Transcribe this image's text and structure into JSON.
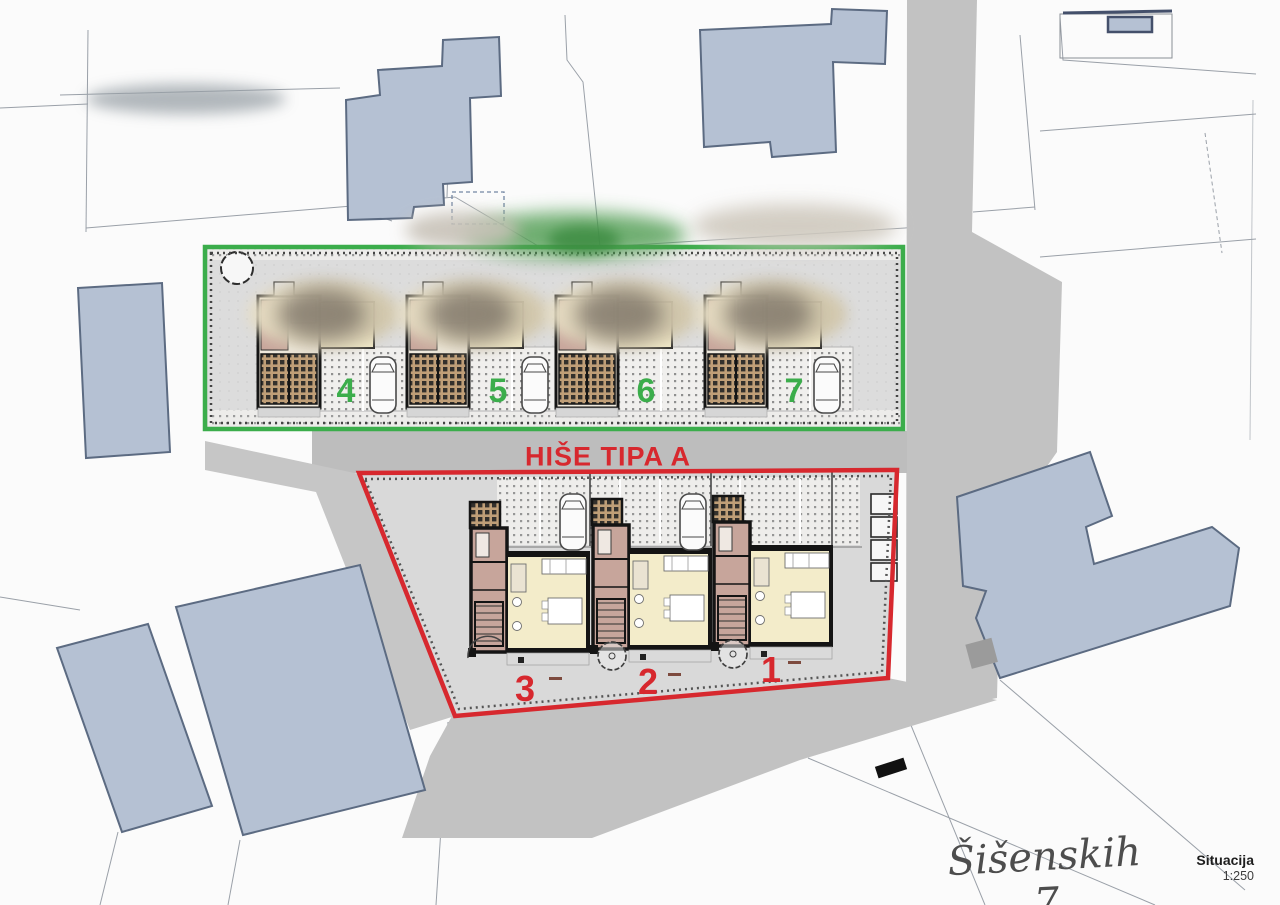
{
  "plan": {
    "zone_green": {
      "house_numbers": [
        "4",
        "5",
        "6",
        "7"
      ],
      "border_color": "#3bad4b"
    },
    "zone_red": {
      "label": "HIŠE TIPA A",
      "house_numbers": [
        "3",
        "2",
        "1"
      ],
      "border_color": "#d7282e"
    }
  },
  "titleblock": {
    "signature": "Šišenskih 7",
    "drawing_title": "Situacija",
    "scale": "1:250"
  },
  "colors": {
    "background": "#fbfbfb",
    "road": "#c2c2c2",
    "zone_ground": "#dcdcdc",
    "existing_building_fill": "#b5c1d3",
    "existing_building_stroke": "#5c6b82",
    "floor_cream": "#f3ecca",
    "hall_pink": "#c7a59b",
    "wall_dark": "#141414"
  }
}
